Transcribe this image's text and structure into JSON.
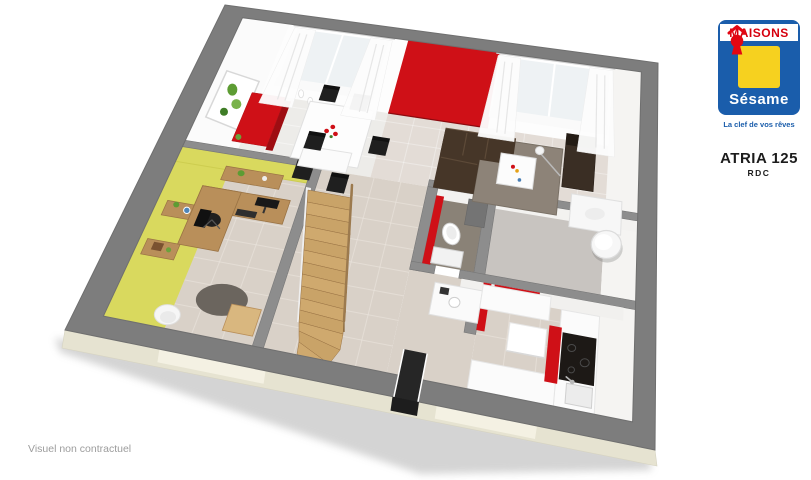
{
  "logo": {
    "brand_top": "MAISONS",
    "brand_name": "Sésame",
    "tagline": "La clef de vos rêves"
  },
  "plan": {
    "title": "ATRIA 125",
    "subtitle": "RDC"
  },
  "footer": {
    "disclaimer": "Visuel non contractuel"
  },
  "colors": {
    "logo_blue": "#1a5dab",
    "logo_yellow": "#f6d11f",
    "logo_red": "#e30613",
    "brand_text_red": "#d6000e",
    "wall_gray": "#7d7d7d",
    "partition_gray": "#8d8d8d",
    "accent_red": "#cf1017",
    "accent_red_dark": "#9e0d12",
    "office_yellow": "#d9d95e",
    "office_yellow_deep": "#cdcd4f",
    "floor_dining": "#edece9",
    "floor_living": "#e3dcd6",
    "floor_beige": "#d9d1c8",
    "floor_wc": "#8a8277",
    "floor_cellier": "#c8c4c0",
    "facade_cream": "#e6e3d1",
    "facade_light": "#f4f1e4",
    "wood": "#cfa96e",
    "wood_mid": "#b98f5a",
    "wood_dark": "#9a7344",
    "sofa_brown": "#463628",
    "sofa_line": "#5d4a38",
    "rug_living": "#8d8378",
    "rug_office": "#6b655e",
    "chair_black": "#1f1f1f",
    "glass": "#eef2f4",
    "white": "#ffffff",
    "door_dark": "#262626",
    "face_white": "#f5f4f2"
  }
}
